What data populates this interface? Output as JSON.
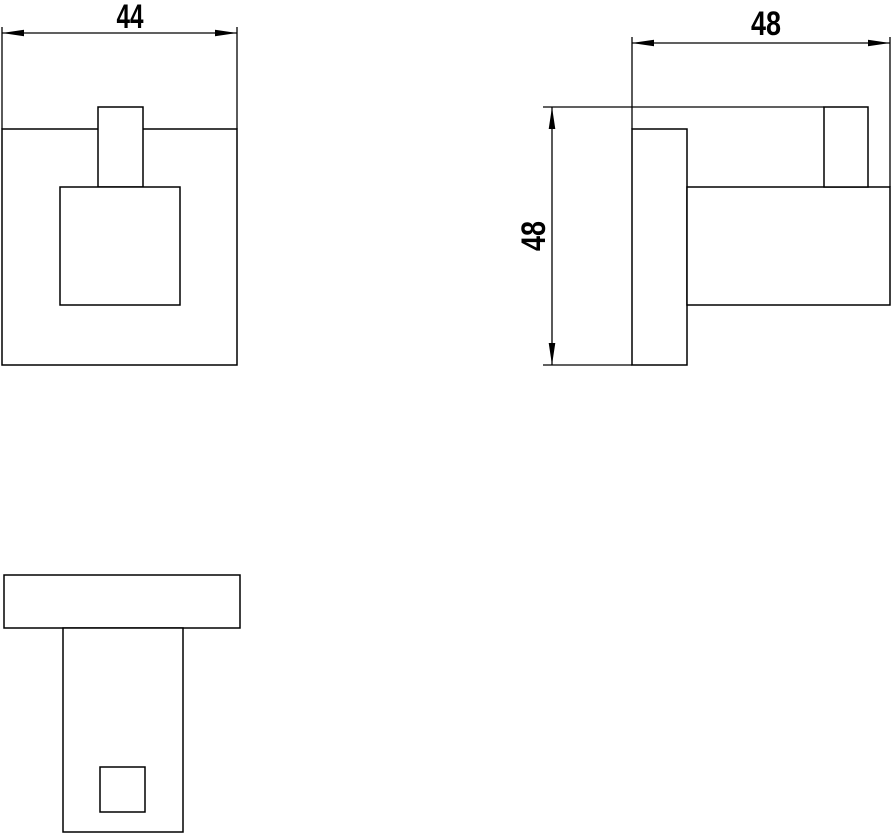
{
  "page": {
    "background_color": "#ffffff",
    "line_color": "#000000",
    "text_color": "#000000"
  },
  "drawing": {
    "view_count": 3,
    "dimensions": {
      "front_width_label": "44",
      "side_depth_label": "48",
      "side_height_label": "48"
    }
  }
}
